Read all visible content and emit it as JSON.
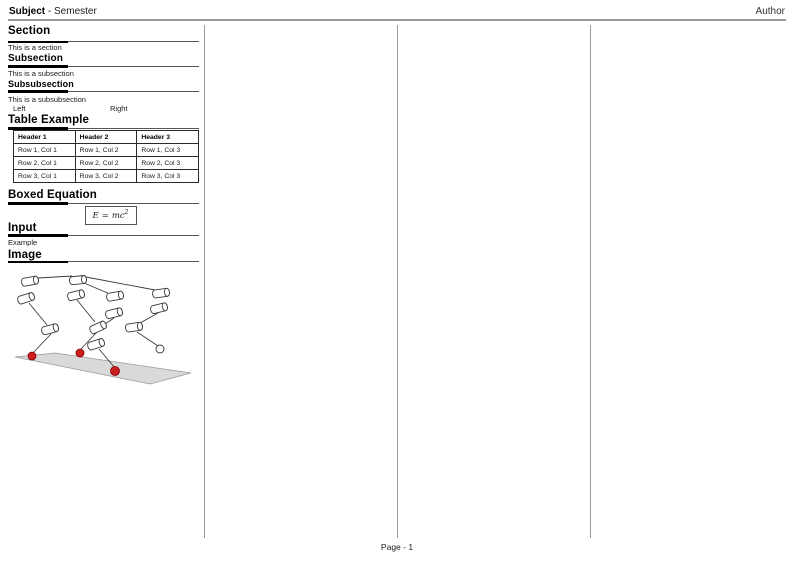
{
  "header": {
    "subject": "Subject",
    "title_rest": "- Semester",
    "author": "Author"
  },
  "footer": {
    "page_label": "Page - 1"
  },
  "column1": {
    "section": {
      "title": "Section",
      "body": "This is a section"
    },
    "subsection": {
      "title": "Subsection",
      "body": "This is a subsection"
    },
    "subsubsection": {
      "title": "Subsubsection",
      "body": "This is a subsubsection"
    },
    "two_col": {
      "left": "Left",
      "right": "Right"
    },
    "table": {
      "title": "Table Example",
      "headers": [
        "Header 1",
        "Header 2",
        "Header 3"
      ],
      "rows": [
        [
          "Row 1, Col 1",
          "Row 1, Col 2",
          "Row 1, Col 3"
        ],
        [
          "Row 2, Col 1",
          "Row 2, Col 2",
          "Row 2, Col 3"
        ],
        [
          "Row 3, Col 1",
          "Row 3, Col 2",
          "Row 3, Col 3"
        ]
      ]
    },
    "boxed_equation": {
      "title": "Boxed Equation",
      "lhs": "E",
      "relation": "=",
      "rhs_base": "mc",
      "rhs_exponent": "2"
    },
    "input": {
      "title": "Input",
      "body": "Example"
    },
    "image": {
      "title": "Image",
      "description": "Kinematic sketch of a quadruped robot: white cylindrical joints linked by rods, three red foot contact points on a gray ground plane and one lifted foot shown as a white circle",
      "colors": {
        "foot": "#cc1f1f",
        "foot_stroke": "#7e0000",
        "ground": "#d9d9d9",
        "ground_stroke": "#999999",
        "line": "#3a3a3a"
      }
    }
  }
}
